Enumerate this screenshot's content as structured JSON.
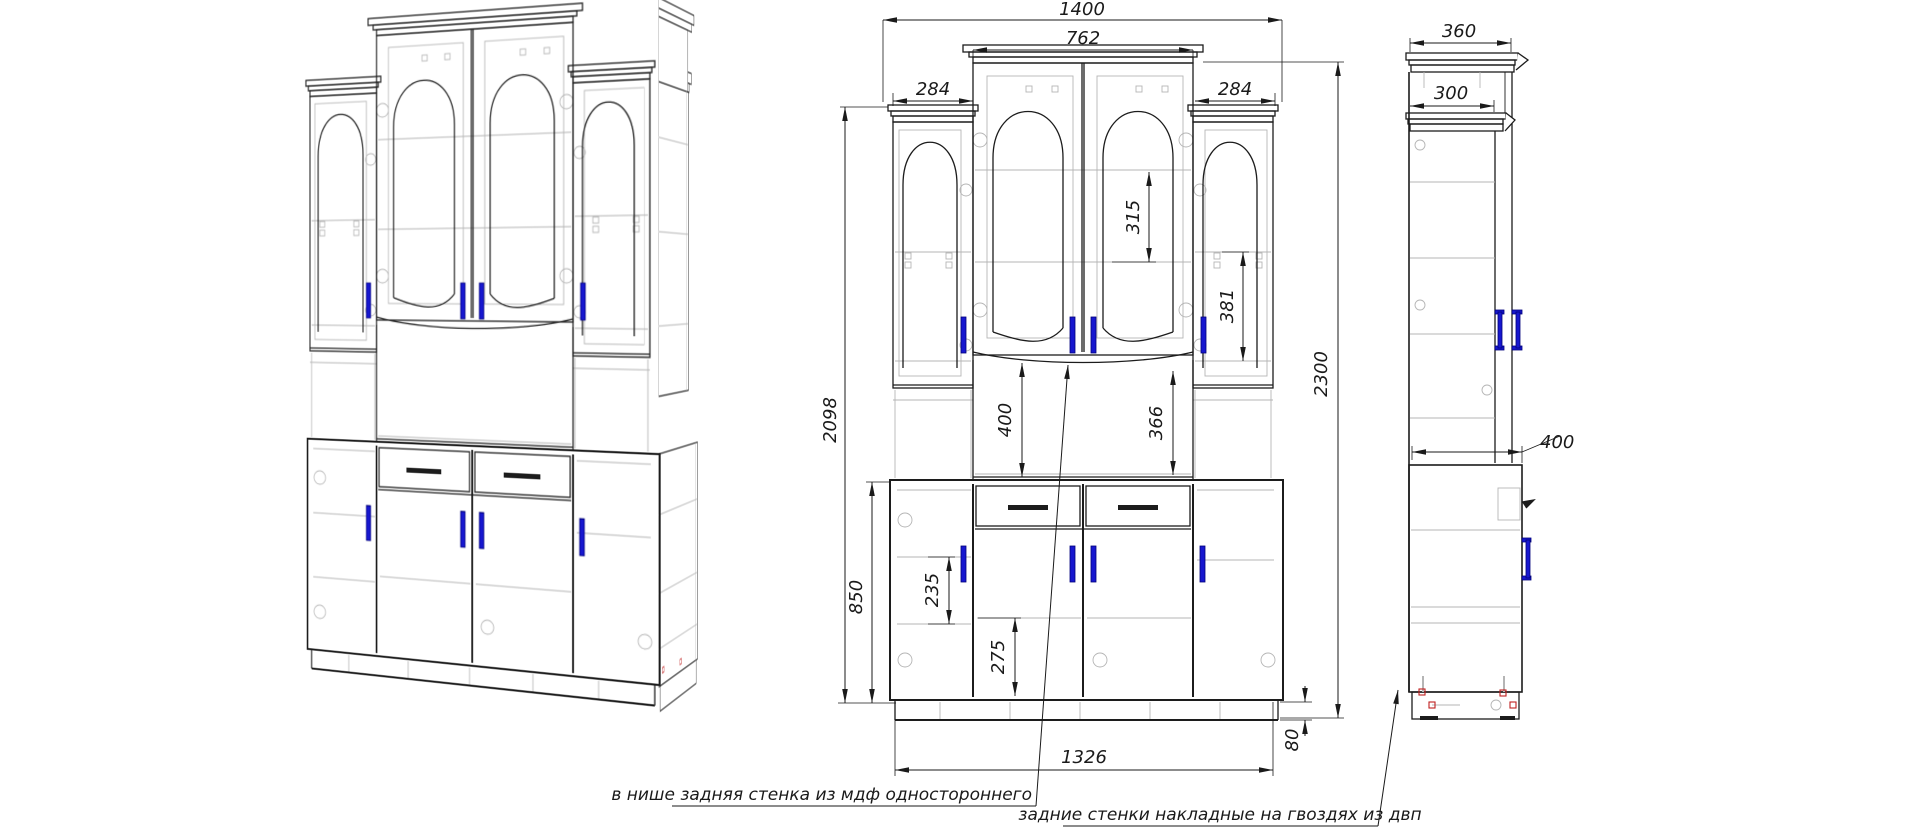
{
  "front_view": {
    "dims": {
      "overall_width": "1400",
      "center_width": "762",
      "left_wing_width": "284",
      "right_wing_width": "284",
      "upper_height": "2098",
      "total_height": "2300",
      "center_glass_gap": "315",
      "wing_glass_gap": "381",
      "niche_height_left": "400",
      "niche_height_right": "366",
      "base_height": "850",
      "base_shelf_gap_left": "235",
      "base_shelf_gap_center": "275",
      "base_inner_width": "1326",
      "plinth_height": "80"
    }
  },
  "side_view": {
    "dims": {
      "cornice_depth": "360",
      "upper_depth": "300",
      "base_depth": "400"
    }
  },
  "annotations": {
    "niche_back_note": "в нише задняя стенка из мдф одностороннего",
    "back_panels_note": "задние стенки накладные на гвоздях из двп"
  },
  "colors": {
    "line": "#1c1c1c",
    "construction": "#b5b5b5",
    "handle_blue": "#1717cf",
    "nail_red": "#c02020"
  }
}
